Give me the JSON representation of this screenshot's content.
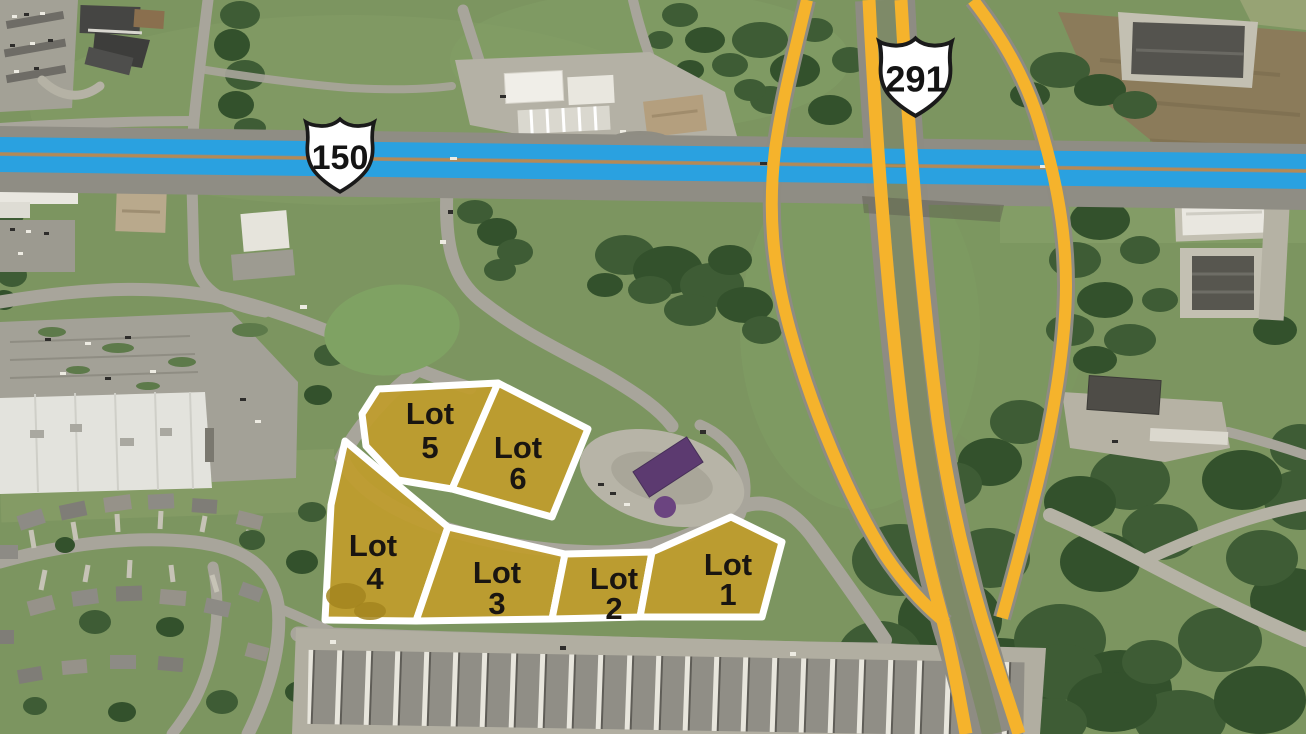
{
  "map": {
    "description": "Aerial photo of a highway interchange with six highlighted commercial lots for sale",
    "route_shields": [
      {
        "id": "us-291",
        "icon": "us-route-shield-icon",
        "number": "291"
      },
      {
        "id": "us-150",
        "icon": "us-route-shield-icon",
        "number": "150"
      }
    ],
    "lots": [
      {
        "name": "Lot 1",
        "label": "Lot",
        "number": "1"
      },
      {
        "name": "Lot 2",
        "label": "Lot",
        "number": "2"
      },
      {
        "name": "Lot 3",
        "label": "Lot",
        "number": "3"
      },
      {
        "name": "Lot 4",
        "label": "Lot",
        "number": "4"
      },
      {
        "name": "Lot 5",
        "label": "Lot",
        "number": "5"
      },
      {
        "name": "Lot 6",
        "label": "Lot",
        "number": "6"
      }
    ],
    "colors": {
      "lot_fill": "#C09C2C",
      "lot_border": "#FFFFFF",
      "highway_highlight": "#F5B32C",
      "road_highlight": "#2AA1E0"
    }
  }
}
